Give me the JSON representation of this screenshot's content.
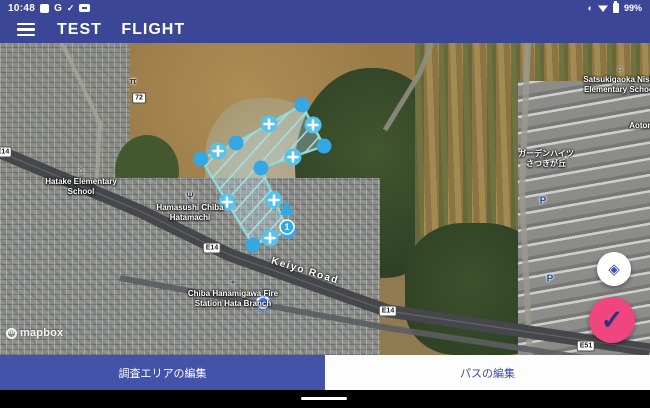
{
  "status_bar": {
    "time": "10:48",
    "google_badge": "G",
    "check_glyph": "✓",
    "battery_percent": "99%",
    "data_saver_glyph": "◐"
  },
  "header": {
    "title": "TEST FLIGHT"
  },
  "map": {
    "attribution_word": "mapbox",
    "attribution_mark": "m",
    "labels": [
      {
        "name": "poi-shrine",
        "glyph": "π",
        "lines": [],
        "x": 133,
        "y": 33
      },
      {
        "name": "poi-hatake-elementary-school",
        "glyph": "⌂",
        "lines": [
          "Hatake Elementary",
          "School"
        ],
        "x": 81,
        "y": 122
      },
      {
        "name": "poi-hamasushi-chiba-hatamachi",
        "glyph": "Ψ",
        "lines": [
          "Hamasushi Chiba",
          "Hatamachi"
        ],
        "x": 190,
        "y": 148
      },
      {
        "name": "poi-chiba-hanamigawa-fire-station",
        "glyph": "+",
        "lines": [
          "Chiba Hanamigawa Fire",
          "Station Hata Branch"
        ],
        "x": 233,
        "y": 234
      },
      {
        "name": "poi-satsukigaoka-nishi-elementary-school",
        "glyph": "⌂",
        "lines": [
          "Satsukigaoka Nishi",
          "Elementary School"
        ],
        "x": 620,
        "y": 20
      },
      {
        "name": "poi-aotori",
        "glyph": "",
        "lines": [
          "Aotori"
        ],
        "x": 641,
        "y": 78
      },
      {
        "name": "poi-garden-heights-satsukigaoka",
        "glyph": "",
        "lines": [
          "ガーデンハイツ",
          "さつきが丘"
        ],
        "x": 546,
        "y": 106
      }
    ],
    "road_label": {
      "text": "Keiyo Road",
      "x": 305,
      "y": 228,
      "rotate": 17
    },
    "shields": [
      {
        "text": "E14",
        "x": 3,
        "y": 109
      },
      {
        "text": "72",
        "x": 139,
        "y": 55
      },
      {
        "text": "E14",
        "x": 212,
        "y": 205
      },
      {
        "text": "E14",
        "x": 388,
        "y": 268
      },
      {
        "text": "E51",
        "x": 586,
        "y": 303
      }
    ],
    "parking_labels": [
      {
        "text": "P",
        "x": 543,
        "y": 158
      },
      {
        "text": "P",
        "x": 550,
        "y": 236
      }
    ],
    "roads": {
      "keiyo": [
        [
          0,
          109
        ],
        [
          140,
          168
        ],
        [
          230,
          212
        ],
        [
          388,
          268
        ],
        [
          650,
          307
        ]
      ],
      "rail": [
        [
          120,
          235
        ],
        [
          388,
          285
        ],
        [
          650,
          325
        ]
      ],
      "branch": [
        [
          385,
          87
        ],
        [
          420,
          30
        ],
        [
          432,
          0
        ]
      ],
      "right_street": [
        [
          528,
          0
        ],
        [
          522,
          150
        ],
        [
          530,
          312
        ]
      ],
      "left_street": [
        [
          62,
          0
        ],
        [
          100,
          80
        ],
        [
          96,
          150
        ]
      ]
    },
    "survey_polygon": {
      "vertices": [
        [
          302,
          62
        ],
        [
          324,
          103
        ],
        [
          261,
          125
        ],
        [
          288,
          188
        ],
        [
          253,
          202
        ],
        [
          201,
          116
        ],
        [
          236,
          100
        ]
      ],
      "midpoints": [
        [
          313,
          82
        ],
        [
          293,
          114
        ],
        [
          274,
          157
        ],
        [
          270,
          195
        ],
        [
          227,
          159
        ],
        [
          218,
          108
        ],
        [
          269,
          81
        ]
      ],
      "fill": "rgba(186,225,235,0.32)",
      "stroke": "#8fd8d8",
      "hatch_color": "#a8e0e0",
      "vertex_color": "#35a7e3",
      "midpoint_color": "#55c2f0"
    },
    "path_start": {
      "label": "1",
      "x": 287,
      "y": 184
    },
    "user_location": {
      "x": 263,
      "y": 259
    }
  },
  "fabs": {
    "locate_glyph": "◈",
    "confirm_glyph": "✓"
  },
  "tabs": {
    "items": [
      {
        "label": "調査エリアの編集"
      },
      {
        "label": "パスの編集"
      }
    ]
  }
}
